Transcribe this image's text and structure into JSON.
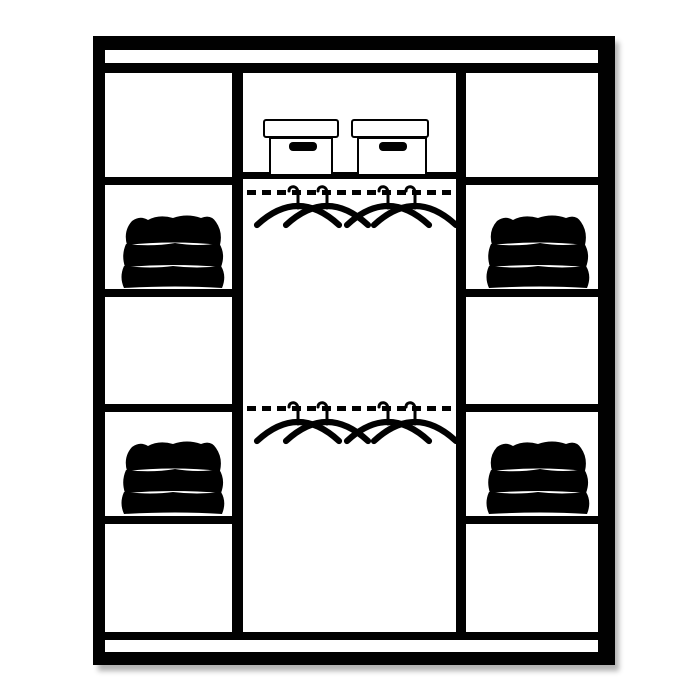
{
  "diagram": {
    "subject": "wardrobe-interior-storage-layout",
    "colors": {
      "background": "#ffffff",
      "line": "#010101",
      "clothes_outline": "#474747",
      "shadow": "rgba(0,0,0,0.30)"
    },
    "structure": {
      "side_columns": [
        {
          "name": "left-shelf-column",
          "compartments": 5,
          "folded_stacks": 2
        },
        {
          "name": "right-shelf-column",
          "compartments": 5,
          "folded_stacks": 2
        }
      ],
      "center_section": {
        "name": "center-hanging-section",
        "storage_boxes": 2,
        "rails": [
          {
            "name": "upper-hanging-rail",
            "hangers": 4
          },
          {
            "name": "lower-hanging-rail",
            "hangers": 4
          }
        ]
      },
      "folded_stack_layers": 3
    },
    "icons": [
      "storage-box-icon",
      "hanger-icon",
      "folded-clothes-icon",
      "hanging-rail"
    ]
  }
}
